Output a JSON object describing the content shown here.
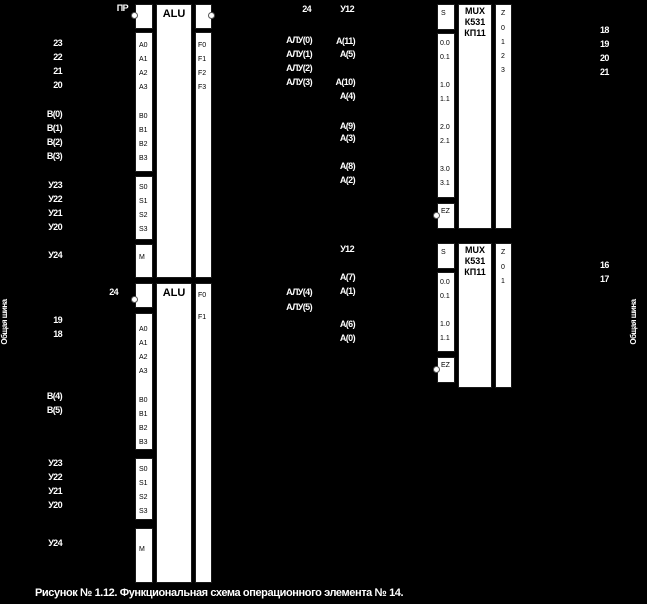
{
  "caption": "Рисунок № 1.12. Функциональная схема операционного элемента № 14.",
  "bus": {
    "left": "Общая шина",
    "right": "Общая шина"
  },
  "alu1": {
    "title": "ALU",
    "pins": {
      "a": [
        "A0",
        "A1",
        "A2",
        "A3"
      ],
      "b": [
        "B0",
        "B1",
        "B2",
        "B3"
      ],
      "s": [
        "S0",
        "S1",
        "S2",
        "S3"
      ],
      "m": "M",
      "f": [
        "F0",
        "F1",
        "F2",
        "F3"
      ]
    },
    "signals": {
      "carry_in": "ПР",
      "carry_out": "24",
      "a": [
        "23",
        "22",
        "21",
        "20"
      ],
      "b": [
        "В(0)",
        "В(1)",
        "В(2)",
        "В(3)"
      ],
      "s": [
        "У23",
        "У22",
        "У21",
        "У20"
      ],
      "m": "У24",
      "f": [
        "АЛУ(0)",
        "АЛУ(1)",
        "АЛУ(2)",
        "АЛУ(3)"
      ]
    }
  },
  "alu2": {
    "title": "ALU",
    "pins": {
      "a": [
        "A0",
        "A1",
        "A2",
        "A3"
      ],
      "b": [
        "B0",
        "B1",
        "B2",
        "B3"
      ],
      "s": [
        "S0",
        "S1",
        "S2",
        "S3"
      ],
      "m": "M",
      "f": [
        "F0",
        "F1"
      ]
    },
    "signals": {
      "carry_in": "24",
      "a": [
        "19",
        "18"
      ],
      "b": [
        "В(4)",
        "В(5)"
      ],
      "s": [
        "У23",
        "У22",
        "У21",
        "У20"
      ],
      "m": "У24",
      "f": [
        "АЛУ(4)",
        "АЛУ(5)"
      ]
    }
  },
  "mux1": {
    "title": [
      "MUX",
      "К531",
      "КП11"
    ],
    "pins": {
      "s": "S",
      "inputs": [
        "0.0",
        "0.1",
        "1.0",
        "1.1",
        "2.0",
        "2.1",
        "3.0",
        "3.1"
      ],
      "ez": "EZ",
      "z": "Z",
      "outputs": [
        "0",
        "1",
        "2",
        "3"
      ]
    },
    "signals": {
      "select": "У12",
      "inputs": [
        "А(11)",
        "А(5)",
        "А(10)",
        "А(4)",
        "А(9)",
        "А(3)",
        "А(8)",
        "А(2)"
      ],
      "outputs": [
        "18",
        "19",
        "20",
        "21"
      ]
    }
  },
  "mux2": {
    "title": [
      "MUX",
      "К531",
      "КП11"
    ],
    "pins": {
      "s": "S",
      "inputs": [
        "0.0",
        "0.1",
        "1.0",
        "1.1"
      ],
      "ez": "EZ",
      "z": "Z",
      "outputs": [
        "0",
        "1"
      ]
    },
    "signals": {
      "select": "У12",
      "inputs": [
        "А(7)",
        "А(1)",
        "А(6)",
        "А(0)"
      ],
      "outputs": [
        "16",
        "17"
      ]
    }
  }
}
